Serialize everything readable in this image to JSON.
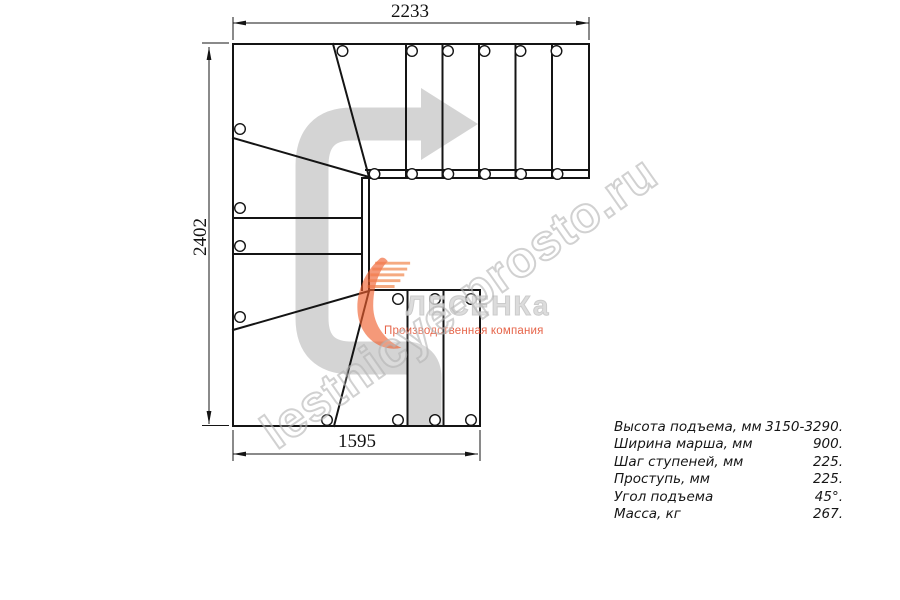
{
  "drawing": {
    "dim_top": "2233",
    "dim_left": "2402",
    "dim_bottom": "1595"
  },
  "specs": {
    "rows": [
      {
        "label": "Высота подъема, мм",
        "value": "3150-3290."
      },
      {
        "label": "Ширина марша, мм",
        "value": "900."
      },
      {
        "label": "Шаг ступеней, мм",
        "value": "225."
      },
      {
        "label": "Проступь, мм",
        "value": "225."
      },
      {
        "label": "Угол подъема",
        "value": "45°."
      },
      {
        "label": "Масса, кг",
        "value": "267."
      }
    ]
  },
  "brand": {
    "watermark": "lestnicye-prosto.ru",
    "logo_text": "ЛЕСЕНКа",
    "logo_tagline": "Производственная компания"
  },
  "colors": {
    "line": "#141414",
    "direction_arrow": "#d4d4d4",
    "logo_orange": "#ef5f2e",
    "tagline_red": "#e24a2a",
    "watermark_gray": "#c3c3c3"
  }
}
